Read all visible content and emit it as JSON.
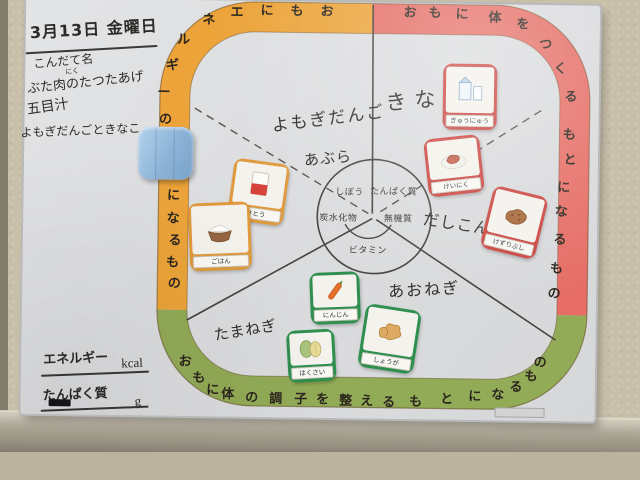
{
  "header": {
    "date": "3月13日 金曜日",
    "menu_title": "こんだて名",
    "furigana_niku": "にく",
    "menu_lines": [
      "ぶた肉のたつたあげ",
      "五目汁",
      "よもぎだんごときなこ"
    ]
  },
  "groups": {
    "energy": {
      "title": "おもにエネルギーのもとになるもの",
      "color": "#eca43a"
    },
    "body": {
      "title": "おもに体をつくるもとになるもの",
      "color": "#e66e66"
    },
    "regulate": {
      "title": "おもに体の調子を整えるもとになるもの",
      "color": "#92ab57"
    }
  },
  "nutrients": {
    "fat": "しぼう",
    "protein": "たんぱく質",
    "carbohydrate": "炭水化物",
    "mineral": "無機質",
    "vitamin": "ビタミン"
  },
  "notes": {
    "yomogi_dango": "よもぎだんご",
    "kinako": "きなこ",
    "abura": "あぶら",
    "dashi_konbu": "だしこんぶ",
    "aonegi": "あおねぎ",
    "tamanegi": "たまねぎ"
  },
  "cards": [
    {
      "label": "さとう",
      "group": "energy",
      "border": "#e09a3e"
    },
    {
      "label": "ごはん",
      "group": "energy",
      "border": "#e09a3e"
    },
    {
      "label": "ぎゅうにゅう",
      "group": "body",
      "border": "#cc4540"
    },
    {
      "label": "けいにく",
      "group": "body",
      "border": "#cc4540"
    },
    {
      "label": "けずりぶし",
      "group": "body",
      "border": "#cc4540"
    },
    {
      "label": "にんじん",
      "group": "regulate",
      "border": "#2f8f4f"
    },
    {
      "label": "はくさい",
      "group": "regulate",
      "border": "#2f8f4f"
    },
    {
      "label": "しょうが",
      "group": "regulate",
      "border": "#2f8f4f"
    }
  ],
  "footer": {
    "energy_label": "エネルギー",
    "energy_unit": "kcal",
    "protein_label": "たんぱく質",
    "protein_unit": "g"
  }
}
